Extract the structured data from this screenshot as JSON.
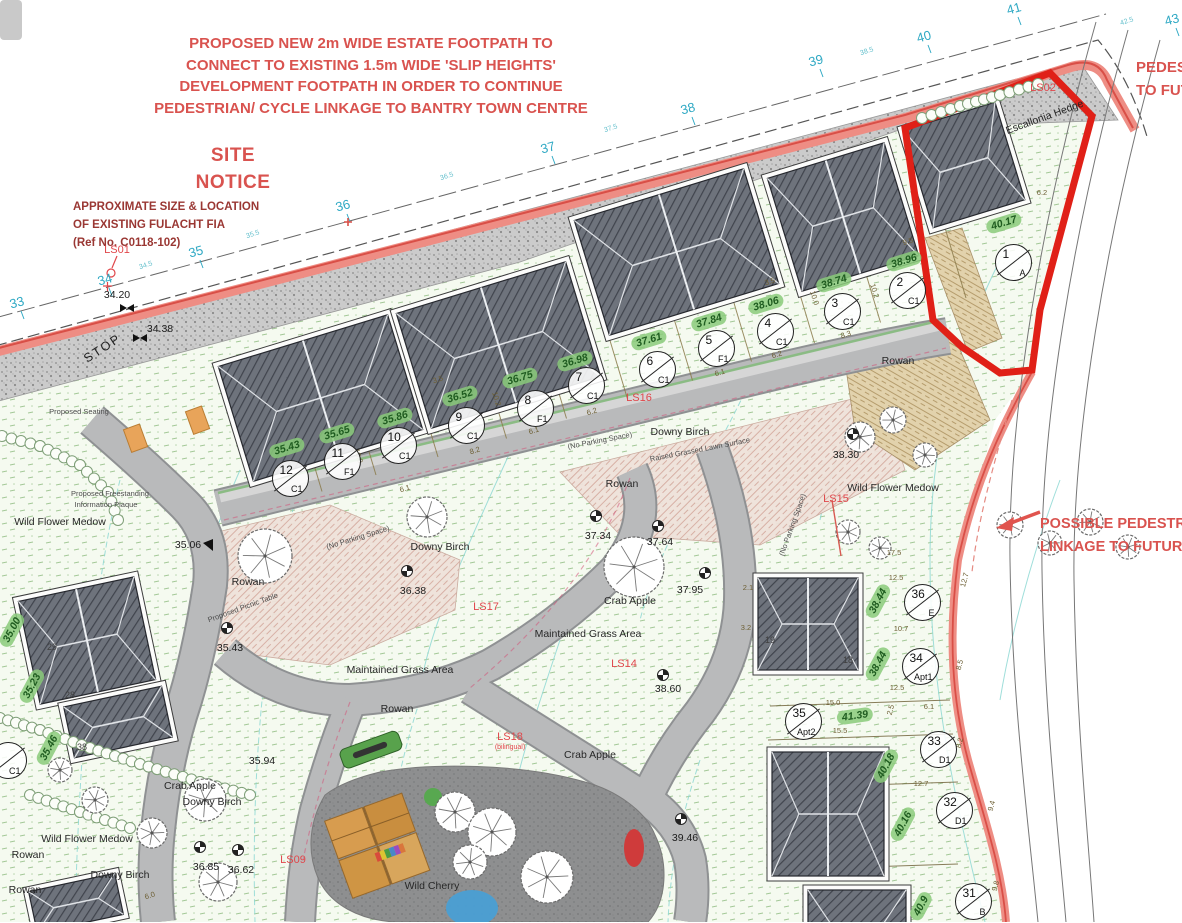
{
  "colors": {
    "annotation_red": "#d9534f",
    "notice_maroon": "#9a3733",
    "boundary_salmon": "#ee8d84",
    "boundary_red": "#d94f47",
    "highlight_red": "#e02017",
    "chainage_cyan": "#2fa9c4",
    "level_green": "#8aca7a",
    "road_gray": "#b9babb",
    "roof_gray": "#6e737c"
  },
  "annotations": {
    "footpath_note": [
      "PROPOSED NEW 2m WIDE ESTATE FOOTPATH TO",
      "CONNECT TO EXISTING 1.5m WIDE 'SLIP HEIGHTS'",
      "DEVELOPMENT FOOTPATH IN ORDER TO CONTINUE",
      "PEDESTRIAN/ CYCLE LINKAGE TO BANTRY TOWN CENTRE"
    ],
    "site_notice": [
      "SITE",
      "NOTICE"
    ],
    "fulacht": [
      "APPROXIMATE SIZE & LOCATION",
      "OF EXISTING FULACHT FIA",
      "(Ref No. C0118-102)"
    ],
    "ped_top": [
      "PEDESTRIAN",
      "TO FUTURE"
    ],
    "possible": [
      "POSSIBLE PEDESTRIAN",
      "LINKAGE TO FUTURE"
    ]
  },
  "stop_label": "STOP",
  "chainage": [
    {
      "t": "33",
      "x": 17,
      "y": 303
    },
    {
      "t": "34",
      "x": 105,
      "y": 280
    },
    {
      "t": "35",
      "x": 196,
      "y": 252
    },
    {
      "t": "36",
      "x": 343,
      "y": 206
    },
    {
      "t": "37",
      "x": 548,
      "y": 148
    },
    {
      "t": "38",
      "x": 688,
      "y": 109
    },
    {
      "t": "39",
      "x": 816,
      "y": 61
    },
    {
      "t": "40",
      "x": 924,
      "y": 37
    },
    {
      "t": "41",
      "x": 1014,
      "y": 9
    },
    {
      "t": "43",
      "x": 1172,
      "y": 20
    }
  ],
  "chainage_minor": [
    {
      "t": "34.5",
      "x": 146,
      "y": 266,
      "r": -18
    },
    {
      "t": "35.5",
      "x": 253,
      "y": 235,
      "r": -18
    },
    {
      "t": "36.5",
      "x": 447,
      "y": 177,
      "r": -18
    },
    {
      "t": "37.5",
      "x": 611,
      "y": 129,
      "r": -18
    },
    {
      "t": "38.5",
      "x": 867,
      "y": 52,
      "r": -18
    },
    {
      "t": "42.5",
      "x": 1127,
      "y": 22,
      "r": -18
    }
  ],
  "spot_levels": [
    {
      "t": "34.20",
      "x": 117,
      "y": 296
    },
    {
      "t": "34.38",
      "x": 160,
      "y": 330
    },
    {
      "t": "35.06",
      "x": 188,
      "y": 546
    },
    {
      "t": "36.38",
      "x": 413,
      "y": 592
    },
    {
      "t": "35.43",
      "x": 230,
      "y": 649
    },
    {
      "t": "37.34",
      "x": 598,
      "y": 537
    },
    {
      "t": "37.64",
      "x": 660,
      "y": 543
    },
    {
      "t": "37.95",
      "x": 690,
      "y": 591
    },
    {
      "t": "38.30",
      "x": 846,
      "y": 456
    },
    {
      "t": "38.60",
      "x": 668,
      "y": 690
    },
    {
      "t": "39.46",
      "x": 685,
      "y": 839
    },
    {
      "t": "36.85",
      "x": 206,
      "y": 868
    },
    {
      "t": "36.62",
      "x": 241,
      "y": 871
    },
    {
      "t": "35.94",
      "x": 262,
      "y": 762
    }
  ],
  "green_levels": [
    {
      "t": "35.43",
      "x": 287,
      "y": 448,
      "r": -17
    },
    {
      "t": "35.65",
      "x": 337,
      "y": 433,
      "r": -17
    },
    {
      "t": "35.86",
      "x": 395,
      "y": 418,
      "r": -17
    },
    {
      "t": "36.52",
      "x": 460,
      "y": 396,
      "r": -17
    },
    {
      "t": "36.75",
      "x": 520,
      "y": 378,
      "r": -17
    },
    {
      "t": "36.98",
      "x": 575,
      "y": 361,
      "r": -17
    },
    {
      "t": "37.61",
      "x": 649,
      "y": 340,
      "r": -17
    },
    {
      "t": "37.84",
      "x": 709,
      "y": 321,
      "r": -17
    },
    {
      "t": "38.06",
      "x": 766,
      "y": 304,
      "r": -17
    },
    {
      "t": "38.74",
      "x": 834,
      "y": 282,
      "r": -17
    },
    {
      "t": "38.96",
      "x": 904,
      "y": 261,
      "r": -17
    },
    {
      "t": "40.17",
      "x": 1004,
      "y": 223,
      "r": -17
    },
    {
      "t": "35.00",
      "x": 12,
      "y": 630,
      "r": -62
    },
    {
      "t": "35.23",
      "x": 32,
      "y": 686,
      "r": -62
    },
    {
      "t": "35.46",
      "x": 49,
      "y": 748,
      "r": -62
    },
    {
      "t": "38.44",
      "x": 878,
      "y": 601,
      "r": -62
    },
    {
      "t": "38.44",
      "x": 878,
      "y": 664,
      "r": -62
    },
    {
      "t": "41.39",
      "x": 855,
      "y": 716,
      "r": -8
    },
    {
      "t": "40.18",
      "x": 886,
      "y": 766,
      "r": -62
    },
    {
      "t": "40.16",
      "x": 903,
      "y": 824,
      "r": -62
    },
    {
      "t": "40.9",
      "x": 921,
      "y": 906,
      "r": -62
    }
  ],
  "plots": [
    {
      "num": "1",
      "type": "A",
      "x": 1013,
      "y": 262
    },
    {
      "num": "2",
      "type": "C1",
      "x": 907,
      "y": 290
    },
    {
      "num": "3",
      "type": "C1",
      "x": 842,
      "y": 311
    },
    {
      "num": "4",
      "type": "C1",
      "x": 775,
      "y": 331
    },
    {
      "num": "5",
      "type": "F1",
      "x": 716,
      "y": 348
    },
    {
      "num": "6",
      "type": "C1",
      "x": 657,
      "y": 369
    },
    {
      "num": "7",
      "type": "C1",
      "x": 586,
      "y": 385
    },
    {
      "num": "8",
      "type": "F1",
      "x": 535,
      "y": 408
    },
    {
      "num": "9",
      "type": "C1",
      "x": 466,
      "y": 425
    },
    {
      "num": "10",
      "type": "C1",
      "x": 398,
      "y": 445
    },
    {
      "num": "11",
      "type": "F1",
      "x": 342,
      "y": 461
    },
    {
      "num": "12",
      "type": "C1",
      "x": 290,
      "y": 478
    },
    {
      "num": "36",
      "type": "E",
      "x": 922,
      "y": 602
    },
    {
      "num": "34",
      "type": "Apt1",
      "x": 920,
      "y": 666
    },
    {
      "num": "35",
      "type": "Apt2",
      "x": 803,
      "y": 721
    },
    {
      "num": "33",
      "type": "D1",
      "x": 938,
      "y": 749
    },
    {
      "num": "32",
      "type": "D1",
      "x": 954,
      "y": 810
    },
    {
      "num": "31",
      "type": "B",
      "x": 973,
      "y": 901
    },
    {
      "num": "",
      "type": "C1",
      "x": 8,
      "y": 760
    }
  ],
  "ls_labels": [
    {
      "t": "LS01",
      "x": 117,
      "y": 250
    },
    {
      "t": "LS02",
      "x": 1043,
      "y": 88
    },
    {
      "t": "LS15",
      "x": 836,
      "y": 499
    },
    {
      "t": "LS16",
      "x": 639,
      "y": 398
    },
    {
      "t": "LS17",
      "x": 486,
      "y": 607
    },
    {
      "t": "LS14",
      "x": 624,
      "y": 664
    },
    {
      "t": "LS18",
      "x": 510,
      "y": 737
    },
    {
      "t": "LS09",
      "x": 293,
      "y": 860
    }
  ],
  "ls_sub": "(bilingual)",
  "tree_labels": [
    {
      "t": "Escallonia Hedge",
      "x": 1045,
      "y": 118,
      "r": -20
    },
    {
      "t": "Rowan",
      "x": 898,
      "y": 362,
      "r": 0
    },
    {
      "t": "Downy Birch",
      "x": 680,
      "y": 433,
      "r": 0
    },
    {
      "t": "Rowan",
      "x": 622,
      "y": 485,
      "r": 0
    },
    {
      "t": "Downy Birch",
      "x": 440,
      "y": 548,
      "r": 0
    },
    {
      "t": "Rowan",
      "x": 248,
      "y": 583,
      "r": 0
    },
    {
      "t": "Wild Flower Medow",
      "x": 893,
      "y": 489,
      "r": 0
    },
    {
      "t": "Wild Flower Medow",
      "x": 60,
      "y": 523,
      "r": 0
    },
    {
      "t": "Crab Apple",
      "x": 630,
      "y": 602,
      "r": 0
    },
    {
      "t": "Maintained Grass Area",
      "x": 400,
      "y": 671,
      "r": 0
    },
    {
      "t": "Maintained Grass Area",
      "x": 588,
      "y": 635,
      "r": 0
    },
    {
      "t": "Rowan",
      "x": 397,
      "y": 710,
      "r": 0
    },
    {
      "t": "Crab Apple",
      "x": 590,
      "y": 756,
      "r": 0
    },
    {
      "t": "Crab Apple",
      "x": 190,
      "y": 787,
      "r": 0
    },
    {
      "t": "Downy Birch",
      "x": 212,
      "y": 803,
      "r": 0
    },
    {
      "t": "Wild Flower Medow",
      "x": 87,
      "y": 840,
      "r": 0
    },
    {
      "t": "Rowan",
      "x": 28,
      "y": 856,
      "r": 0
    },
    {
      "t": "Rowan",
      "x": 25,
      "y": 891,
      "r": 0
    },
    {
      "t": "Downy Birch",
      "x": 120,
      "y": 876,
      "r": 0
    },
    {
      "t": "Wild Cherry",
      "x": 432,
      "y": 887,
      "r": 0
    }
  ],
  "small_notes": [
    {
      "t": "Raised Grassed Lawn Surface",
      "x": 700,
      "y": 450,
      "r": -11
    },
    {
      "t": "(No Parking Space)",
      "x": 600,
      "y": 441,
      "r": -11
    },
    {
      "t": "(No Parking Space)",
      "x": 358,
      "y": 538,
      "r": -17
    },
    {
      "t": "(No Parking Space)",
      "x": 793,
      "y": 525,
      "r": -70
    },
    {
      "t": "Proposed Seating",
      "x": 79,
      "y": 412,
      "r": 0
    },
    {
      "t": "Proposed Freestanding",
      "x": 110,
      "y": 494,
      "r": 0
    },
    {
      "t": "Information Plaque",
      "x": 106,
      "y": 505,
      "r": 0
    },
    {
      "t": "Proposed Picnic Table",
      "x": 243,
      "y": 608,
      "r": -20
    }
  ],
  "dims": [
    {
      "t": "3.5",
      "x": 770,
      "y": 282,
      "r": -17
    },
    {
      "t": "9.5",
      "x": 908,
      "y": 242,
      "r": -17
    },
    {
      "t": "10.2",
      "x": 874,
      "y": 291,
      "r": 73
    },
    {
      "t": "10.0",
      "x": 814,
      "y": 298,
      "r": 73
    },
    {
      "t": "8.3",
      "x": 846,
      "y": 335,
      "r": -17
    },
    {
      "t": "6.2",
      "x": 777,
      "y": 355,
      "r": -17
    },
    {
      "t": "6.1",
      "x": 720,
      "y": 373,
      "r": -17
    },
    {
      "t": "3.5",
      "x": 438,
      "y": 380,
      "r": -17
    },
    {
      "t": "10.2",
      "x": 496,
      "y": 399,
      "r": 73
    },
    {
      "t": "6.2",
      "x": 592,
      "y": 412,
      "r": -17
    },
    {
      "t": "6.1",
      "x": 534,
      "y": 431,
      "r": -17
    },
    {
      "t": "8.2",
      "x": 475,
      "y": 451,
      "r": -17
    },
    {
      "t": "10.0",
      "x": 358,
      "y": 456,
      "r": 73
    },
    {
      "t": "6.1",
      "x": 405,
      "y": 489,
      "r": -17
    },
    {
      "t": "17.5",
      "x": 894,
      "y": 553,
      "r": 0
    },
    {
      "t": "12.5",
      "x": 896,
      "y": 578,
      "r": 0
    },
    {
      "t": "10.7",
      "x": 901,
      "y": 629,
      "r": 0
    },
    {
      "t": "12.5",
      "x": 897,
      "y": 688,
      "r": 0
    },
    {
      "t": "12.7",
      "x": 965,
      "y": 580,
      "r": -75
    },
    {
      "t": "8.5",
      "x": 960,
      "y": 665,
      "r": -75
    },
    {
      "t": "2.5",
      "x": 891,
      "y": 710,
      "r": -75
    },
    {
      "t": "6.1",
      "x": 929,
      "y": 707,
      "r": 0
    },
    {
      "t": "15.0",
      "x": 833,
      "y": 703,
      "r": 0
    },
    {
      "t": "15.5",
      "x": 840,
      "y": 731,
      "r": 0
    },
    {
      "t": "12.7",
      "x": 921,
      "y": 784,
      "r": 0
    },
    {
      "t": "2.1",
      "x": 748,
      "y": 588,
      "r": 0
    },
    {
      "t": "3.2",
      "x": 746,
      "y": 628,
      "r": 0
    },
    {
      "t": "9.4",
      "x": 992,
      "y": 806,
      "r": -75
    },
    {
      "t": "8.2",
      "x": 960,
      "y": 743,
      "r": -75
    },
    {
      "t": "9.8",
      "x": 996,
      "y": 886,
      "r": -75
    },
    {
      "t": "6.2",
      "x": 1042,
      "y": 193,
      "r": 0
    },
    {
      "t": "6.0",
      "x": 150,
      "y": 896,
      "r": -17
    }
  ],
  "unit_numbers": [
    {
      "t": "19",
      "x": 770,
      "y": 641
    },
    {
      "t": "18",
      "x": 848,
      "y": 661
    },
    {
      "t": "29",
      "x": 52,
      "y": 648
    },
    {
      "t": "28",
      "x": 70,
      "y": 696
    },
    {
      "t": "38",
      "x": 82,
      "y": 748
    }
  ]
}
